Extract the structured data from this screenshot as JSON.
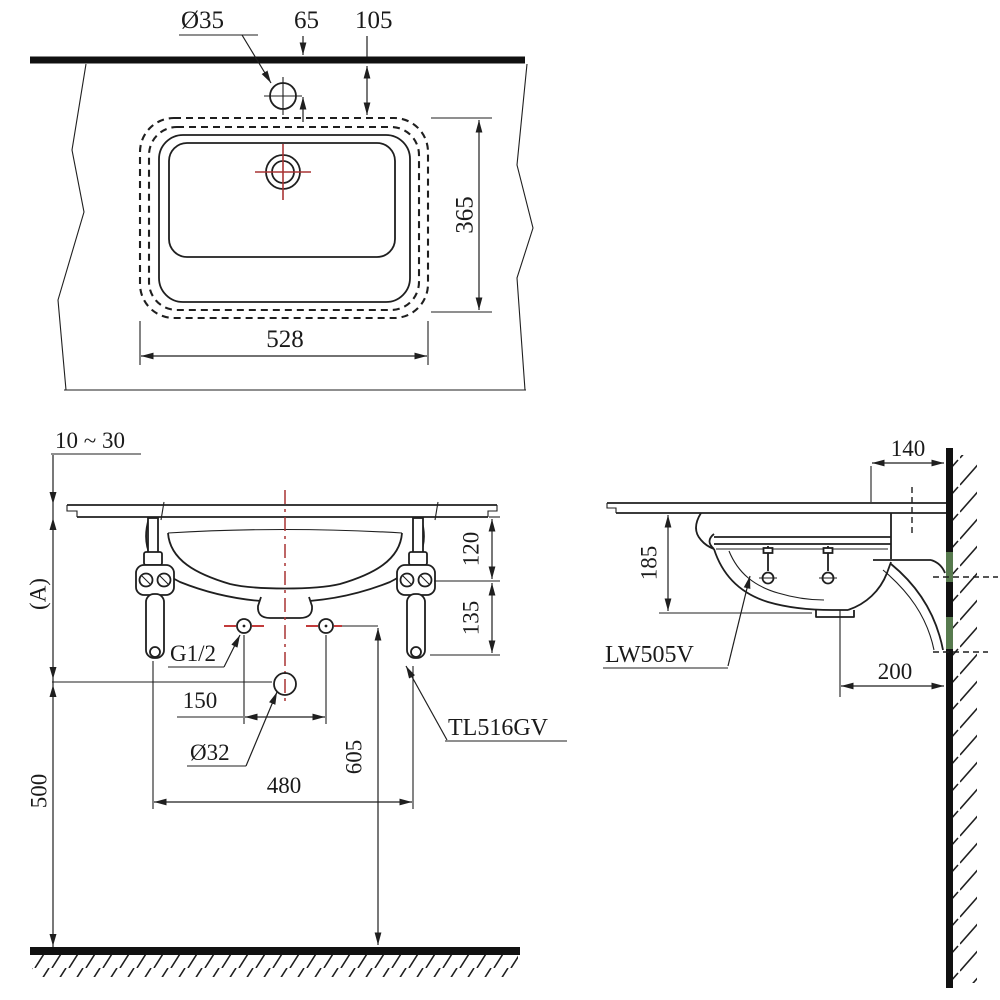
{
  "drawing_title": "Undercounter lavatory installation drawing",
  "top_view": {
    "hole_dia": "Ø35",
    "hole_to_wall": "65",
    "cutout_to_wall": "105",
    "cutout_depth": "365",
    "cutout_width": "528"
  },
  "front_view": {
    "counter_thickness": "10 ~ 30",
    "height_ref": "(A)",
    "rim_to_bolt": "120",
    "bolt_to_bracket": "135",
    "supply_pitch": "150",
    "supply_thread": "G1/2",
    "drain_dia": "Ø32",
    "bracket_pitch": "480",
    "supply_height": "605",
    "drain_height": "500",
    "faucet_model": "TL516GV"
  },
  "side_view": {
    "wall_to_hole": "140",
    "depth_below_counter": "185",
    "drain_to_wall": "200",
    "basin_model": "LW505V"
  },
  "colors": {
    "line": "#1f1f1f",
    "centerline_red": "#a83434",
    "supply_mark_red": "#c23b3b",
    "wall_mark_green": "#6f9e63",
    "background": "#ffffff"
  }
}
